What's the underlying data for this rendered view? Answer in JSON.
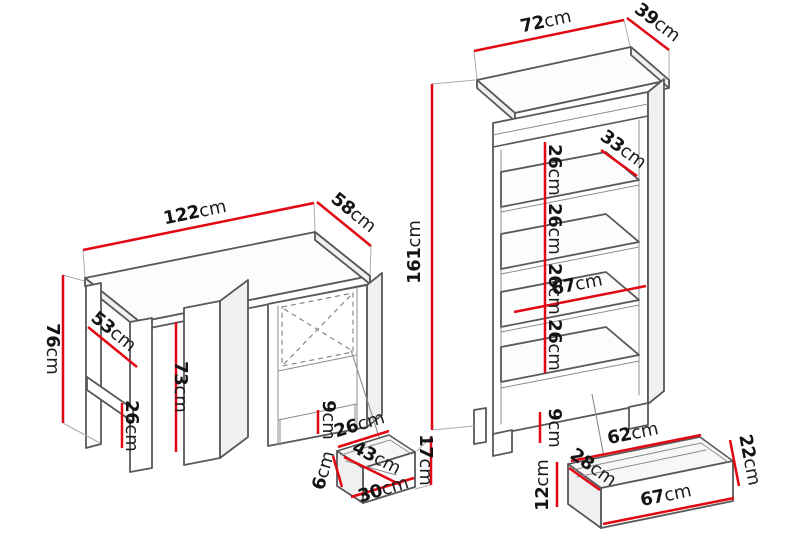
{
  "diagram": {
    "type": "furniture-dimension-drawing",
    "items": [
      "desk",
      "desk-drawer-detail",
      "bookcase",
      "bookcase-drawer-detail"
    ],
    "accent_color": "#e30613",
    "outline_color": "#58585a",
    "background_color": "#ffffff",
    "unit_system": "cm"
  },
  "labels": {
    "desk_width": {
      "value": "122",
      "unit": "cm"
    },
    "desk_depth": {
      "value": "58",
      "unit": "cm"
    },
    "desk_height": {
      "value": "76",
      "unit": "cm"
    },
    "desk_side_depth": {
      "value": "53",
      "unit": "cm"
    },
    "desk_clearance_height": {
      "value": "73",
      "unit": "cm"
    },
    "desk_rail_height": {
      "value": "26",
      "unit": "cm"
    },
    "desk_plinth_height": {
      "value": "9",
      "unit": "cm"
    },
    "desk_drawer_top_width": {
      "value": "26",
      "unit": "cm"
    },
    "desk_drawer_diagonal": {
      "value": "43",
      "unit": "cm"
    },
    "desk_drawer_side_height": {
      "value": "6",
      "unit": "cm"
    },
    "desk_drawer_bottom_width": {
      "value": "30",
      "unit": "cm"
    },
    "desk_drawer_front_height": {
      "value": "17",
      "unit": "cm"
    },
    "bookcase_width": {
      "value": "72",
      "unit": "cm"
    },
    "bookcase_depth": {
      "value": "39",
      "unit": "cm"
    },
    "bookcase_height": {
      "value": "161",
      "unit": "cm"
    },
    "bookcase_gap1": {
      "value": "26",
      "unit": "cm"
    },
    "bookcase_gap2": {
      "value": "26",
      "unit": "cm"
    },
    "bookcase_gap3": {
      "value": "26",
      "unit": "cm"
    },
    "bookcase_gap4": {
      "value": "26",
      "unit": "cm"
    },
    "bookcase_shelf_depth": {
      "value": "33",
      "unit": "cm"
    },
    "bookcase_inner_width": {
      "value": "67",
      "unit": "cm"
    },
    "bookcase_plinth_height": {
      "value": "9",
      "unit": "cm"
    },
    "bookcase_drawer_top_width": {
      "value": "62",
      "unit": "cm"
    },
    "bookcase_drawer_back_height": {
      "value": "22",
      "unit": "cm"
    },
    "bookcase_drawer_depth": {
      "value": "28",
      "unit": "cm"
    },
    "bookcase_drawer_front_height": {
      "value": "12",
      "unit": "cm"
    },
    "bookcase_drawer_bottom_width": {
      "value": "67",
      "unit": "cm"
    }
  }
}
